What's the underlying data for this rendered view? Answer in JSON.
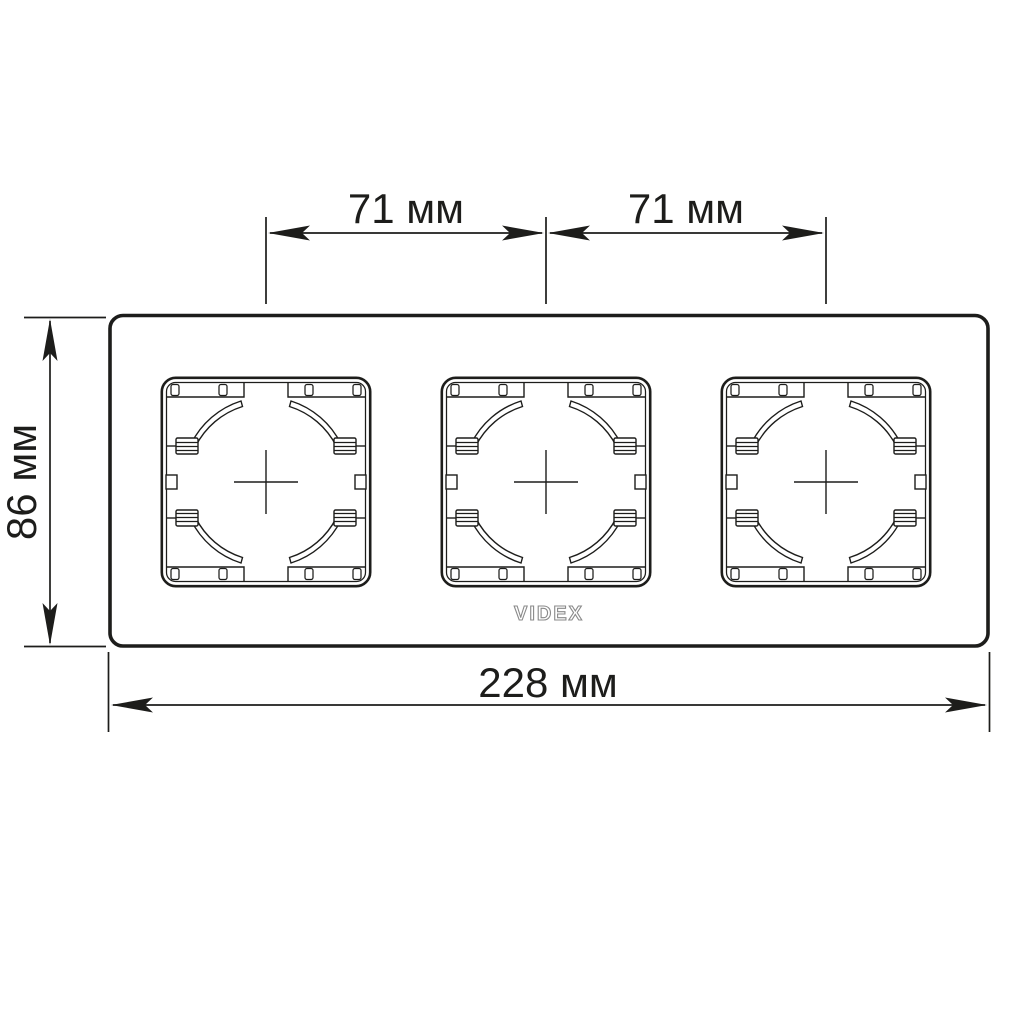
{
  "drawing": {
    "subject": "3-gang wall socket frame, front view",
    "socket_openings": 3
  },
  "colors": {
    "background": "#ffffff",
    "line": "#1d1d1b",
    "logo_outline": "#8a8a8a"
  },
  "dimensions": {
    "top_left_spacing": {
      "label": "71 мм",
      "value": 71,
      "unit": "мм"
    },
    "top_right_spacing": {
      "label": "71 мм",
      "value": 71,
      "unit": "мм"
    },
    "frame_height": {
      "label": "86 мм",
      "value": 86,
      "unit": "мм"
    },
    "frame_width": {
      "label": "228 мм",
      "value": 228,
      "unit": "мм"
    }
  },
  "logo": {
    "text": "VIDEX"
  }
}
